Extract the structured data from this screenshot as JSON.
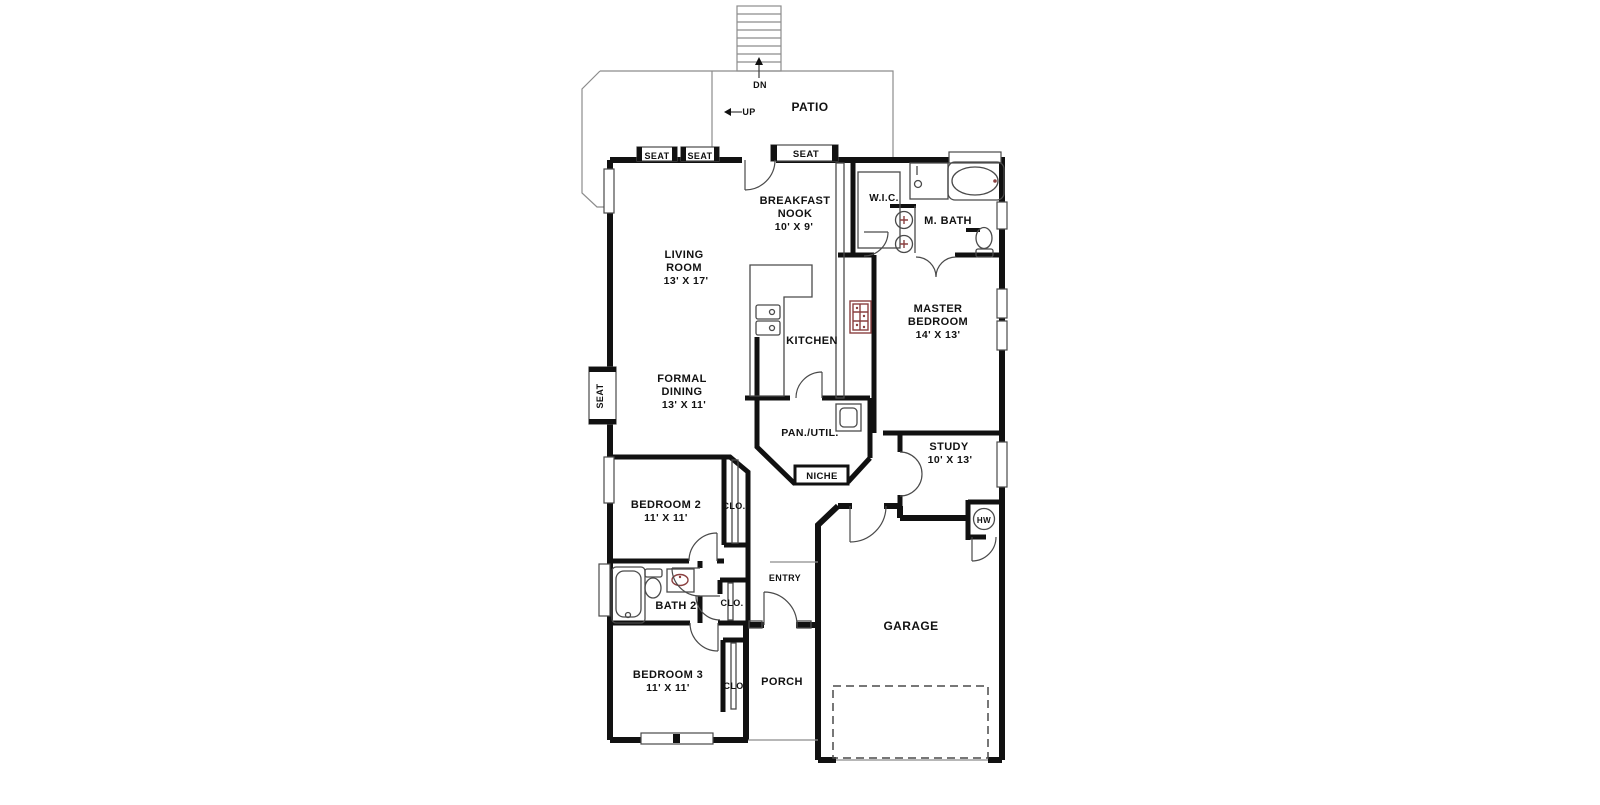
{
  "figure": {
    "kind": "architectural-floor-plan",
    "background": "#ffffff"
  },
  "colors": {
    "wall": "#111111",
    "line": "#4a4a4a",
    "light": "#8c8c8c",
    "fixture": "#8a4040",
    "text": "#111111",
    "bg": "#ffffff"
  },
  "rooms": [
    {
      "name": "PATIO",
      "dimensions": ""
    },
    {
      "name": "BREAKFAST NOOK",
      "dimensions": "10' X 9'"
    },
    {
      "name": "LIVING ROOM",
      "dimensions": "13' X 17'"
    },
    {
      "name": "W.I.C.",
      "dimensions": ""
    },
    {
      "name": "M. BATH",
      "dimensions": ""
    },
    {
      "name": "MASTER BEDROOM",
      "dimensions": "14' X 13'"
    },
    {
      "name": "KITCHEN",
      "dimensions": ""
    },
    {
      "name": "FORMAL DINING",
      "dimensions": "13' X 11'"
    },
    {
      "name": "PAN./UTIL.",
      "dimensions": ""
    },
    {
      "name": "NICHE",
      "dimensions": ""
    },
    {
      "name": "STUDY",
      "dimensions": "10' X 13'"
    },
    {
      "name": "BEDROOM 2",
      "dimensions": "11' X 11'"
    },
    {
      "name": "BATH 2",
      "dimensions": ""
    },
    {
      "name": "BEDROOM 3",
      "dimensions": "11' X 11'"
    },
    {
      "name": "ENTRY",
      "dimensions": ""
    },
    {
      "name": "PORCH",
      "dimensions": ""
    },
    {
      "name": "GARAGE",
      "dimensions": ""
    }
  ],
  "annotations": [
    "DN",
    "UP",
    "SEAT",
    "SEAT",
    "SEAT",
    "SEAT",
    "CLO.",
    "CLO.",
    "CLO.",
    "HW",
    "NICHE"
  ],
  "labels": [
    {
      "id": "dn",
      "t": "DN",
      "x": 760,
      "y": 88,
      "s": 9
    },
    {
      "id": "up",
      "t": "UP",
      "x": 749,
      "y": 115,
      "s": 9
    },
    {
      "id": "patio",
      "t": "PATIO",
      "x": 810,
      "y": 111,
      "s": 12
    },
    {
      "id": "seat-top-1",
      "t": "SEAT",
      "x": 657,
      "y": 159,
      "s": 9
    },
    {
      "id": "seat-top-2",
      "t": "SEAT",
      "x": 700,
      "y": 159,
      "s": 9
    },
    {
      "id": "seat-top-3",
      "t": "SEAT",
      "x": 806,
      "y": 157,
      "s": 9.5
    },
    {
      "id": "seat-left",
      "t": "SEAT",
      "x": 603,
      "y": 396,
      "s": 9,
      "r": -90
    },
    {
      "id": "breakfast-nook-line1",
      "t": "BREAKFAST",
      "x": 795,
      "y": 204,
      "s": 11
    },
    {
      "id": "breakfast-nook-line2",
      "t": "NOOK",
      "x": 795,
      "y": 217,
      "s": 11
    },
    {
      "id": "breakfast-nook-dims",
      "t": "10' X 9'",
      "x": 794,
      "y": 230,
      "s": 10.5
    },
    {
      "id": "wic",
      "t": "W.I.C.",
      "x": 884,
      "y": 201,
      "s": 10
    },
    {
      "id": "m-bath",
      "t": "M. BATH",
      "x": 948,
      "y": 224,
      "s": 11
    },
    {
      "id": "living-line1",
      "t": "LIVING",
      "x": 684,
      "y": 258,
      "s": 11
    },
    {
      "id": "living-line2",
      "t": "ROOM",
      "x": 684,
      "y": 271,
      "s": 11
    },
    {
      "id": "living-dims",
      "t": "13' X 17'",
      "x": 686,
      "y": 284,
      "s": 10.5
    },
    {
      "id": "master-line1",
      "t": "MASTER",
      "x": 938,
      "y": 312,
      "s": 11
    },
    {
      "id": "master-line2",
      "t": "BEDROOM",
      "x": 938,
      "y": 325,
      "s": 11
    },
    {
      "id": "master-dims",
      "t": "14' X 13'",
      "x": 938,
      "y": 338,
      "s": 10.5
    },
    {
      "id": "kitchen",
      "t": "KITCHEN",
      "x": 812,
      "y": 344,
      "s": 11
    },
    {
      "id": "dining-line1",
      "t": "FORMAL",
      "x": 682,
      "y": 382,
      "s": 11
    },
    {
      "id": "dining-line2",
      "t": "DINING",
      "x": 682,
      "y": 395,
      "s": 11
    },
    {
      "id": "dining-dims",
      "t": "13' X 11'",
      "x": 684,
      "y": 408,
      "s": 10.5
    },
    {
      "id": "pantry-util",
      "t": "PAN./UTIL.",
      "x": 810,
      "y": 436,
      "s": 10.5
    },
    {
      "id": "niche",
      "t": "NICHE",
      "x": 822,
      "y": 479,
      "s": 9.5
    },
    {
      "id": "study-line1",
      "t": "STUDY",
      "x": 949,
      "y": 450,
      "s": 11
    },
    {
      "id": "study-dims",
      "t": "10' X 13'",
      "x": 950,
      "y": 463,
      "s": 10.5
    },
    {
      "id": "bedroom2-line1",
      "t": "BEDROOM 2",
      "x": 666,
      "y": 508,
      "s": 11
    },
    {
      "id": "bedroom2-dims",
      "t": "11' X 11'",
      "x": 666,
      "y": 521,
      "s": 10.5
    },
    {
      "id": "clo-bedroom2",
      "t": "CLO.",
      "x": 734,
      "y": 509,
      "s": 9
    },
    {
      "id": "hw",
      "t": "HW",
      "x": 984,
      "y": 523,
      "s": 8
    },
    {
      "id": "bath2",
      "t": "BATH 2",
      "x": 676,
      "y": 609,
      "s": 11
    },
    {
      "id": "entry",
      "t": "ENTRY",
      "x": 785,
      "y": 581,
      "s": 9
    },
    {
      "id": "clo-hall",
      "t": "CLO.",
      "x": 732,
      "y": 606,
      "s": 9
    },
    {
      "id": "bedroom3-line1",
      "t": "BEDROOM 3",
      "x": 668,
      "y": 678,
      "s": 11
    },
    {
      "id": "bedroom3-dims",
      "t": "11' X 11'",
      "x": 668,
      "y": 691,
      "s": 10.5
    },
    {
      "id": "clo-bedroom3",
      "t": "CLO.",
      "x": 735,
      "y": 689,
      "s": 9
    },
    {
      "id": "porch",
      "t": "PORCH",
      "x": 782,
      "y": 685,
      "s": 11
    },
    {
      "id": "garage",
      "t": "GARAGE",
      "x": 911,
      "y": 630,
      "s": 12
    }
  ]
}
